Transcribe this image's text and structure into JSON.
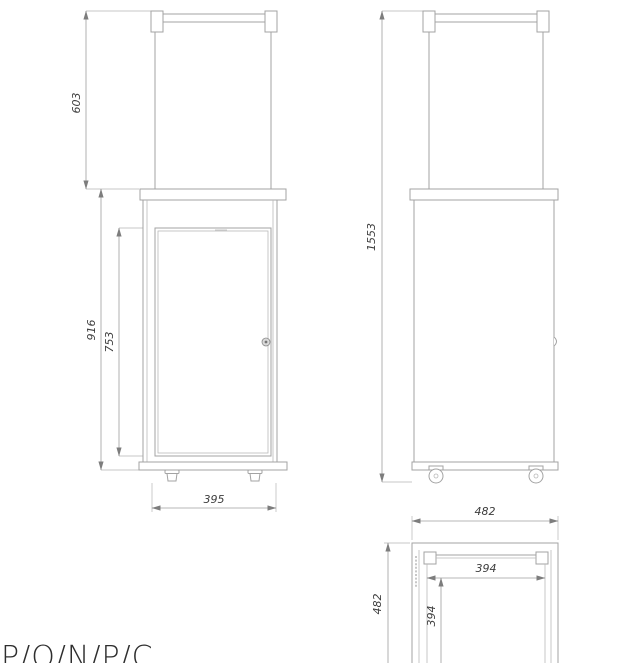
{
  "title_block": {
    "partial_label": "P/O/N/P/C"
  },
  "views": {
    "front": {
      "dimensions": {
        "upper_section_height": "603",
        "housing_height": "916",
        "glass_door_height": "753",
        "width": "395"
      }
    },
    "side": {
      "dimensions": {
        "overall_height": "1553"
      }
    },
    "top": {
      "dimensions": {
        "overall_width": "482",
        "overall_depth": "482",
        "frame_width": "394",
        "frame_depth": "394"
      }
    }
  },
  "style": {
    "line_color": "#a3a3a3",
    "dimension_line_color": "#9f9f9f",
    "text_color": "#3d3d3d",
    "background": "#ffffff"
  }
}
